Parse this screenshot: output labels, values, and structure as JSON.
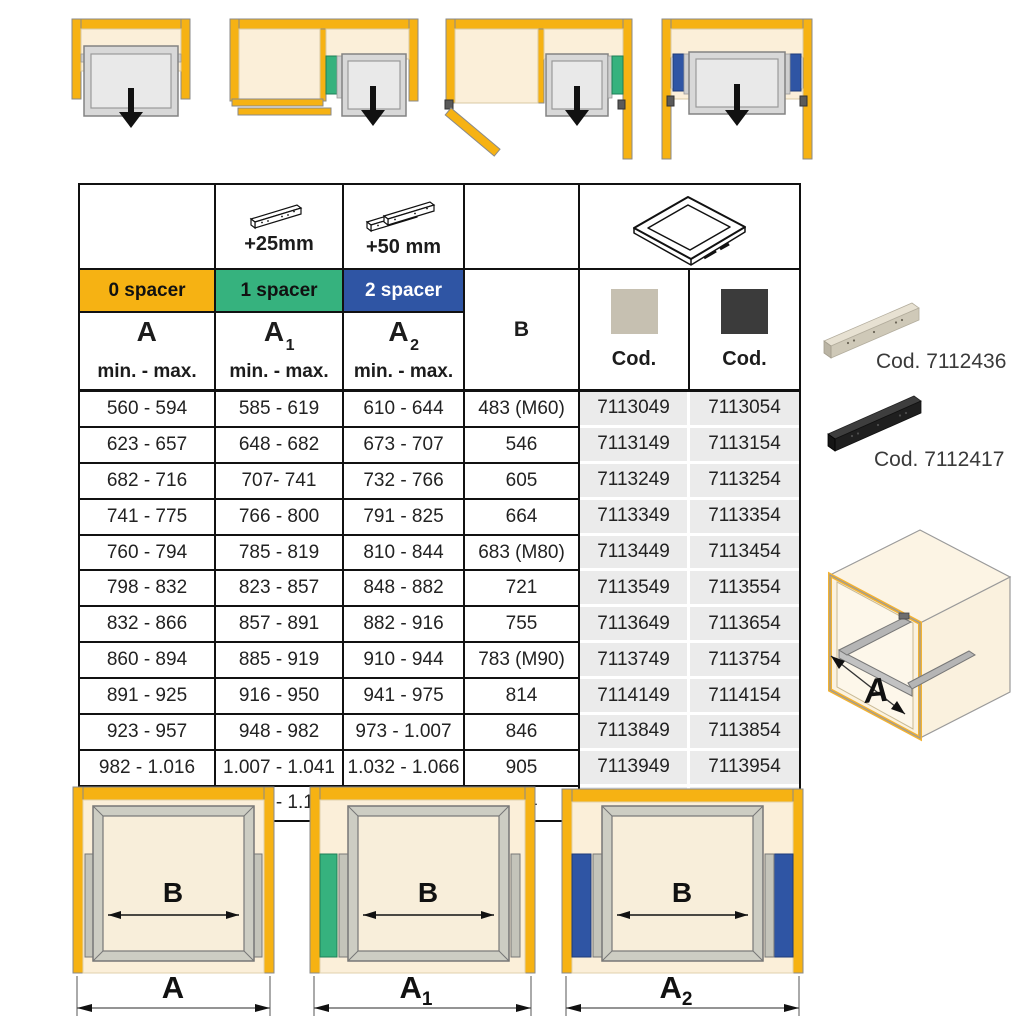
{
  "colors": {
    "yellow": "#F6B213",
    "green": "#36B27E",
    "blue": "#2F55A4",
    "cream": "#FBEFD9",
    "cod_cell_gray": "#EBEBEB",
    "swatch_gray": "#C6C0B1",
    "swatch_black": "#3B3B3B"
  },
  "table": {
    "header": {
      "plus25": "+25mm",
      "plus50": "+50 mm",
      "spacers": [
        "0 spacer",
        "1 spacer",
        "2 spacer"
      ],
      "col_a": {
        "base": "A",
        "sub": ""
      },
      "col_a1": {
        "base": "A",
        "sub": "1"
      },
      "col_a2": {
        "base": "A",
        "sub": "2"
      },
      "min_max": "min. - max.",
      "col_b": "B",
      "cod_label_gray": "Cod.",
      "cod_label_black": "Cod."
    },
    "rows": [
      [
        "560 - 594",
        "585 - 619",
        "610 - 644",
        "483 (M60)",
        "7113049",
        "7113054"
      ],
      [
        "623 - 657",
        "648 - 682",
        "673 - 707",
        "546",
        "7113149",
        "7113154"
      ],
      [
        "682 - 716",
        "707- 741",
        "732 - 766",
        "605",
        "7113249",
        "7113254"
      ],
      [
        "741 - 775",
        "766 - 800",
        "791 - 825",
        "664",
        "7113349",
        "7113354"
      ],
      [
        "760 - 794",
        "785 - 819",
        "810 - 844",
        "683 (M80)",
        "7113449",
        "7113454"
      ],
      [
        "798 - 832",
        "823 - 857",
        "848 - 882",
        "721",
        "7113549",
        "7113554"
      ],
      [
        "832 - 866",
        "857 - 891",
        "882 - 916",
        "755",
        "7113649",
        "7113654"
      ],
      [
        "860 - 894",
        "885 - 919",
        "910 - 944",
        "783 (M90)",
        "7113749",
        "7113754"
      ],
      [
        "891 - 925",
        "916 - 950",
        "941 - 975",
        "814",
        "7114149",
        "7114154"
      ],
      [
        "923 - 957",
        "948 - 982",
        "973 - 1.007",
        "846",
        "7113849",
        "7113854"
      ],
      [
        "982 - 1.016",
        "1.007 - 1.041",
        "1.032 - 1.066",
        "905",
        "7113949",
        "7113954"
      ],
      [
        "1.041 - 1.075",
        "1.066 - 1.100",
        "1.091 - 1.125",
        "964",
        "7114049",
        "7114054"
      ]
    ]
  },
  "side_panel": {
    "spacer_beige_code": "Cod. 7112436",
    "spacer_black_code": "Cod. 7112417",
    "cabinet_width_label": "A"
  },
  "bottom_diagrams": {
    "inner_width_label": "B",
    "a": {
      "base": "A",
      "sub": ""
    },
    "a1": {
      "base": "A",
      "sub": "1"
    },
    "a2": {
      "base": "A",
      "sub": "2"
    }
  }
}
